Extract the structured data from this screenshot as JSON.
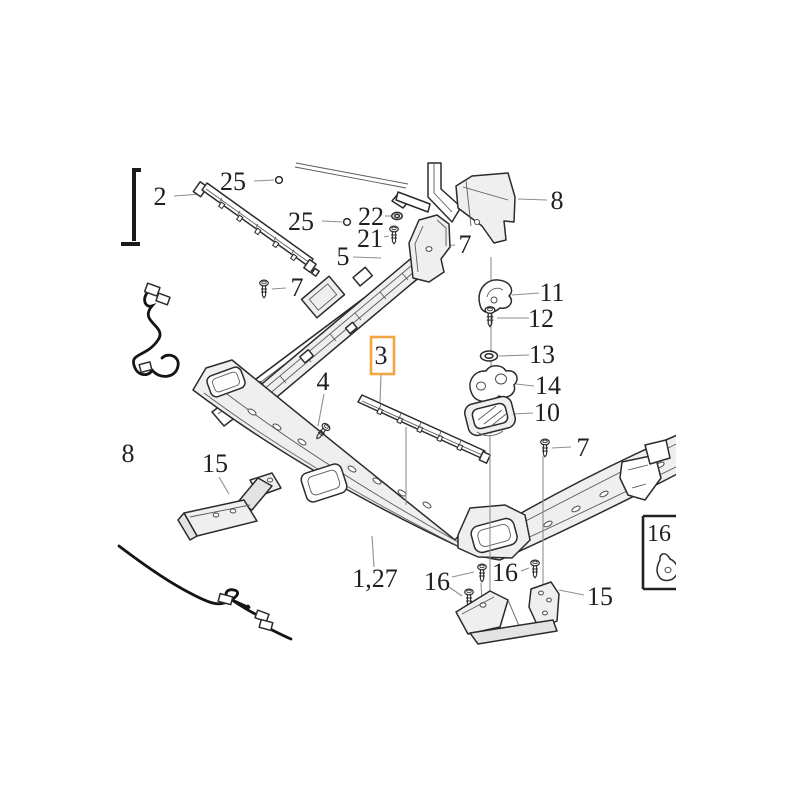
{
  "diagram": {
    "type": "exploded-parts-diagram",
    "background_color": "#ffffff",
    "line_color": "#2b2b30",
    "leader_color": "#8f8f8f",
    "highlight": {
      "part": "3",
      "color": "#F2A644"
    },
    "callouts": {
      "part2": {
        "text": "2"
      },
      "part25a": {
        "text": "25"
      },
      "part25b": {
        "text": "25"
      },
      "part22": {
        "text": "22"
      },
      "part21": {
        "text": "21"
      },
      "part5": {
        "text": "5"
      },
      "part7a": {
        "text": "7"
      },
      "part8a": {
        "text": "8"
      },
      "part7b": {
        "text": "7"
      },
      "part11": {
        "text": "11"
      },
      "part12": {
        "text": "12"
      },
      "part13": {
        "text": "13"
      },
      "part14": {
        "text": "14"
      },
      "part10": {
        "text": "10"
      },
      "part3": {
        "text": "3"
      },
      "part4": {
        "text": "4"
      },
      "part7c": {
        "text": "7"
      },
      "part8b": {
        "text": "8"
      },
      "part15a": {
        "text": "15"
      },
      "part1_27": {
        "text": "1,27"
      },
      "part16a": {
        "text": "16"
      },
      "part16b": {
        "text": "16"
      },
      "part15b": {
        "text": "15"
      },
      "inset16": {
        "text": "16"
      }
    }
  }
}
